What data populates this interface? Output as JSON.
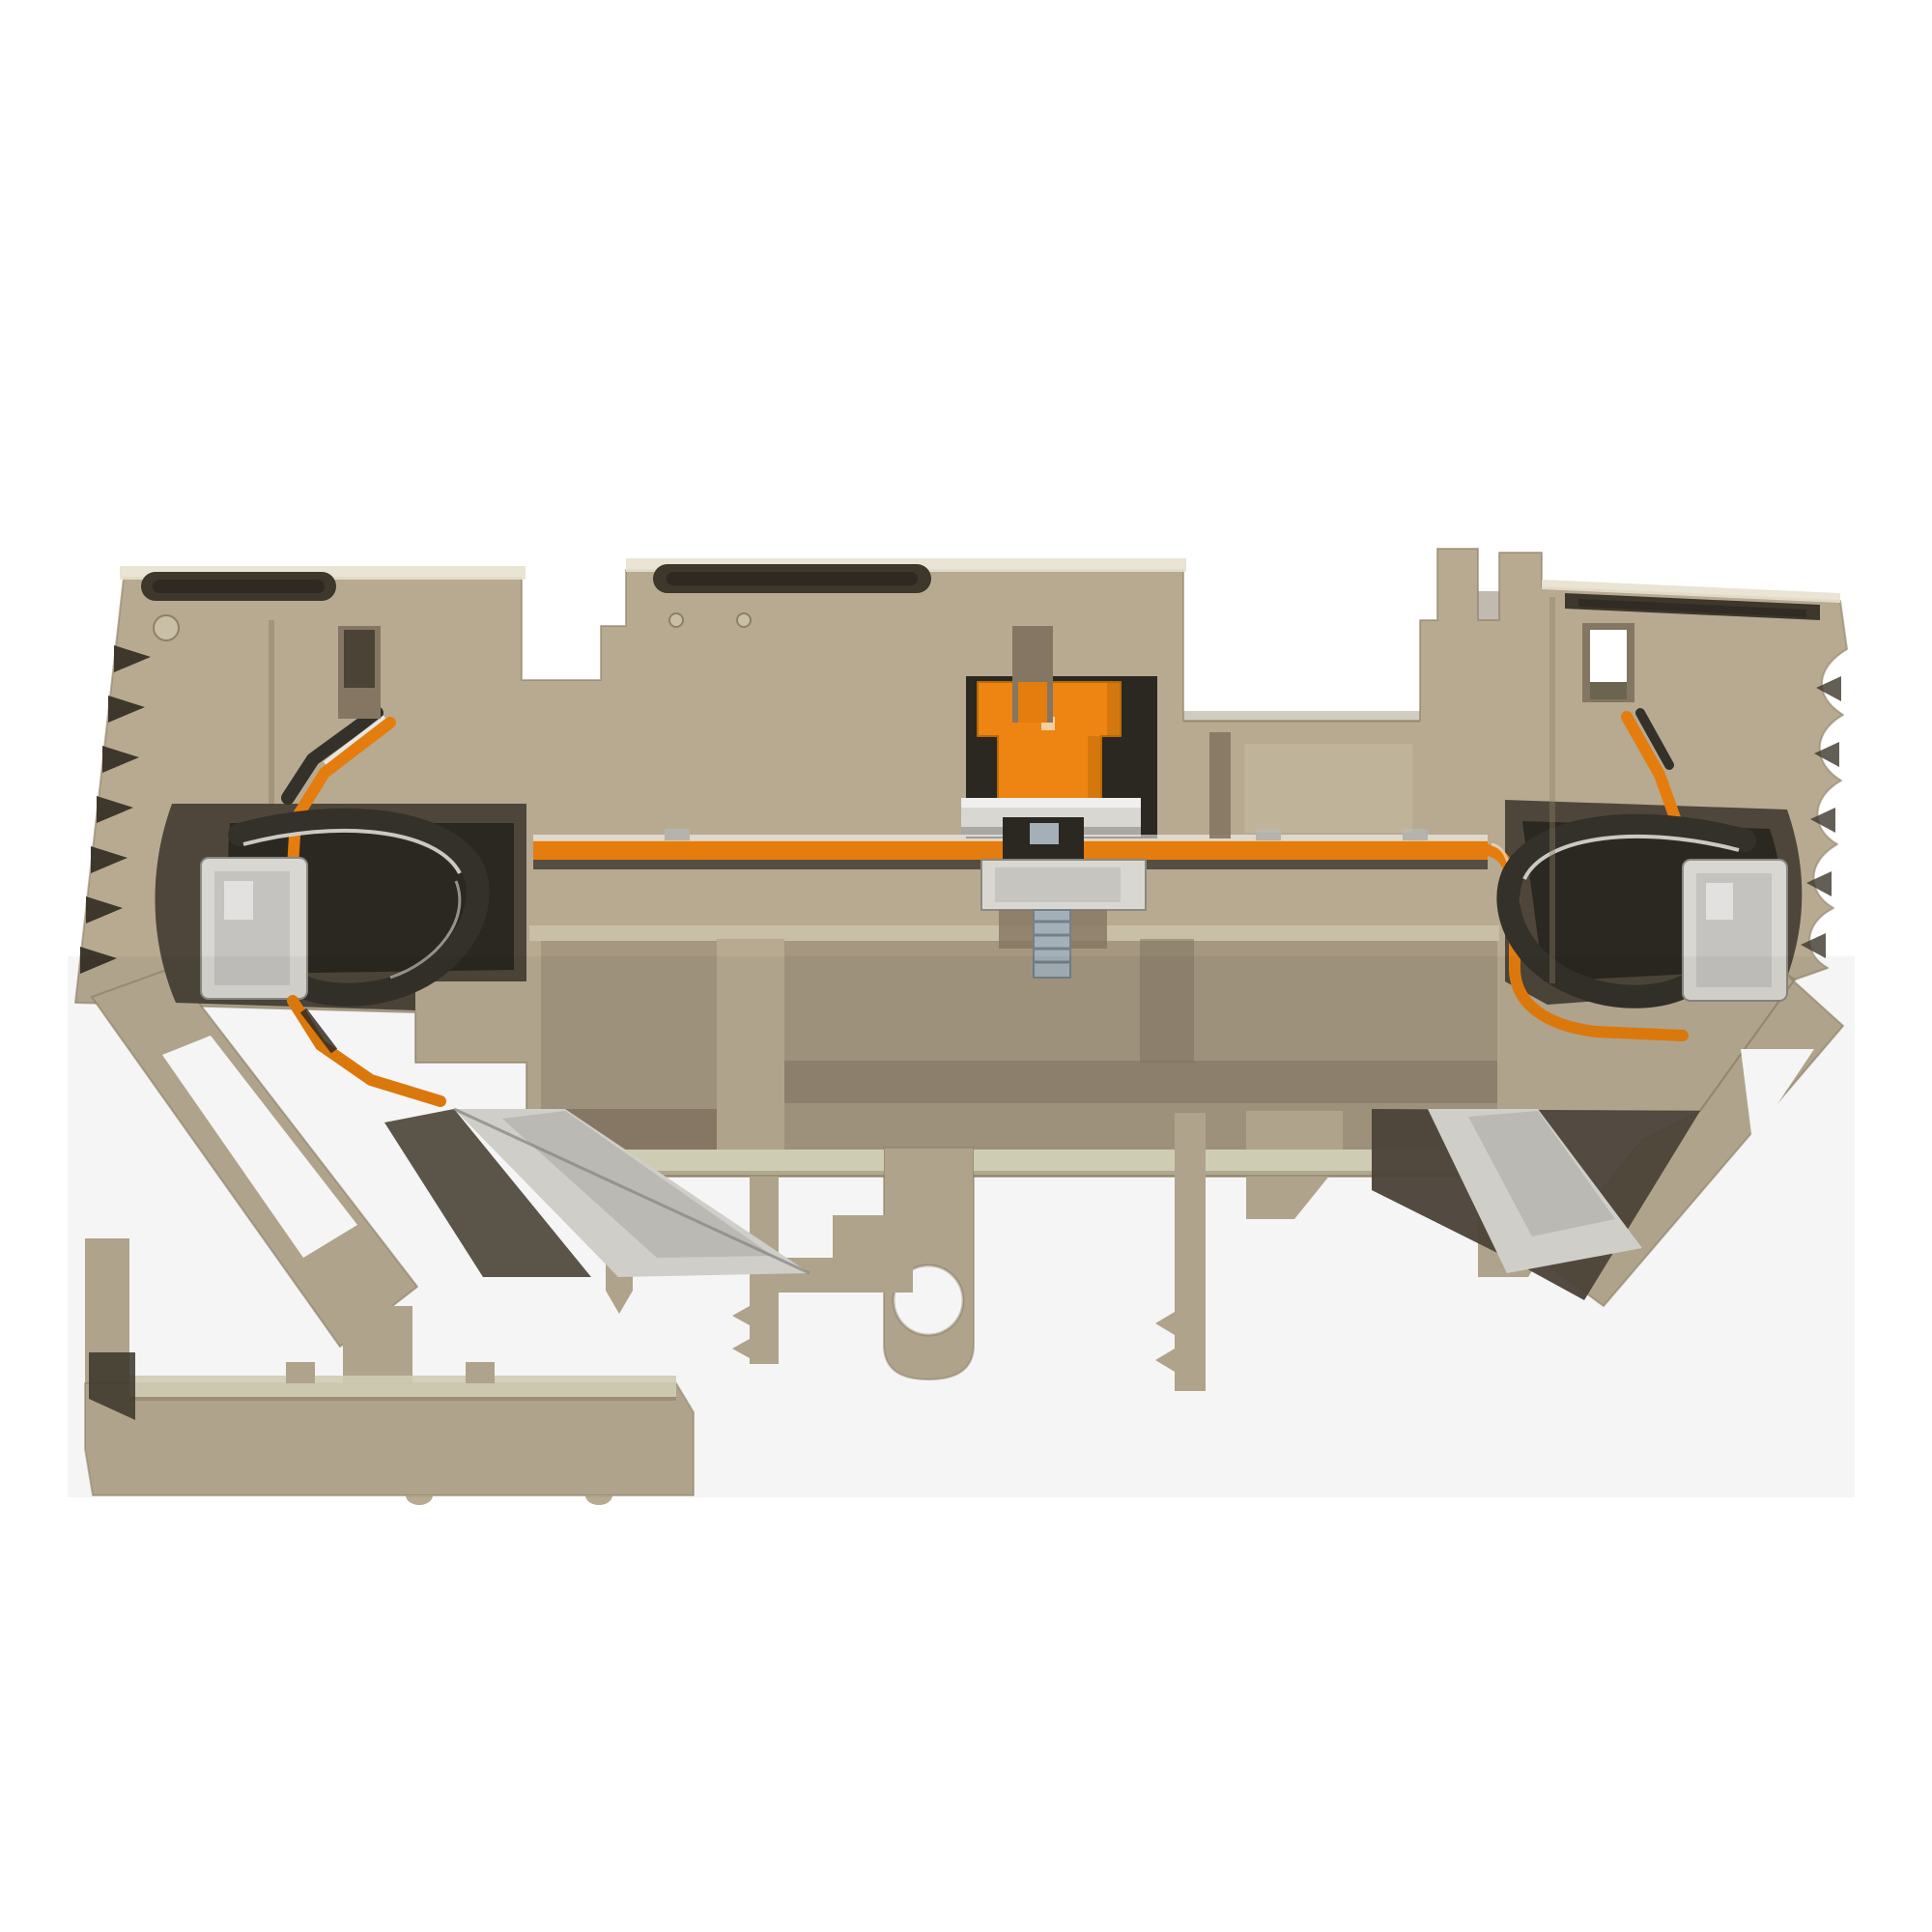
{
  "meta": {
    "type": "product-photo",
    "subject": "Beige DIN-rail tension-clamp terminal block, cross-section side view, with orange test-disconnect plug, internal copper busbar, steel clamp springs and fixing screw, on white background"
  },
  "colors": {
    "background": "#ffffff",
    "body": "#b7aa91",
    "body_light": "#c9bfa6",
    "body_highlight": "#e7e1ce",
    "body_shadow": "#8d8065",
    "recess": "#a59780",
    "recess_dark": "#847662",
    "cavity": "#4e463a",
    "cavity_deep": "#2b2721",
    "hole_dark": "#3d372c",
    "olive": "#6b6450",
    "pale_green": "#d8d5bc",
    "orange": "#ee8512",
    "orange_dark": "#b96a08",
    "conductor": "#e47d0d",
    "silver": "#d8d7d2",
    "silver_mid": "#b4b3ae",
    "silver_dark": "#8a8984",
    "spring": "#34312a",
    "spring_light": "#dcdad1",
    "zinc": "#a4b0b7",
    "zinc_dark": "#73808a",
    "white": "#ffffff",
    "shade": "#000000"
  },
  "parts": [
    "housing body",
    "left wire entry",
    "center wire entry",
    "right wire entry",
    "left tension clamp spring",
    "right tension clamp spring",
    "left contact plate",
    "right contact plate",
    "orange test plug",
    "copper busbar",
    "fixing screw",
    "left clamp yoke",
    "right clamp yoke",
    "DIN rail foot",
    "mounting prong with hole",
    "serrated left edge",
    "scalloped right edge"
  ]
}
